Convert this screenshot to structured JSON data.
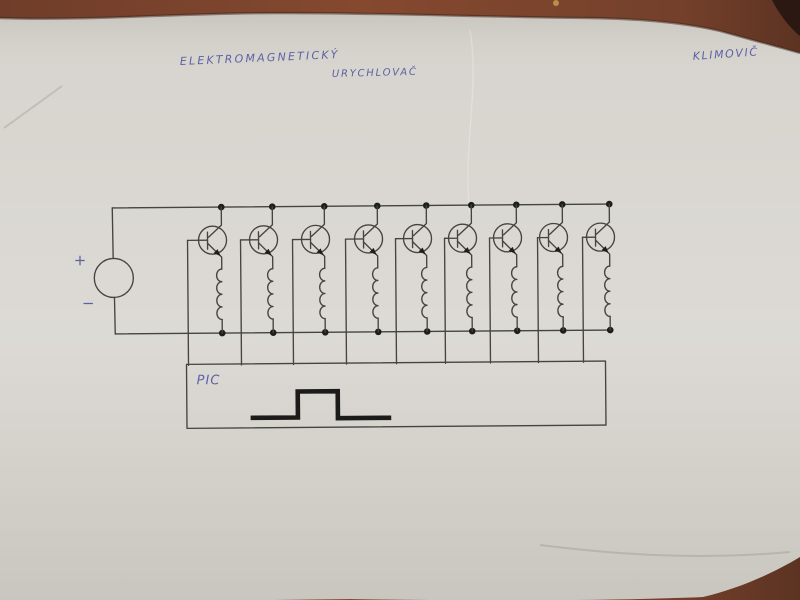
{
  "scene": {
    "description": "Photograph of a hand-drawn electronic schematic on a sheet of white paper lying on a reddish-brown wooden table",
    "table_color": "#7c4430",
    "table_dark_corner": "#2b1812",
    "paper_color": "#d6d3cd",
    "ink_color": "#45443f",
    "dot_color": "#1d1d1b",
    "pen_color": "#5c61a6",
    "pulse_color": "#1b1b19"
  },
  "handwriting": {
    "title_line1": "ELEKTROMAGNETICKÝ",
    "title_line2": "URYCHLOVAČ",
    "author": "KLIMOVIČ",
    "plus": "+",
    "minus": "−",
    "pic_label": "PIC"
  },
  "schematic": {
    "type": "circuit-diagram",
    "description": "Multi-stage electromagnetic accelerator (coilgun) driver: DC source on common supply rails feeding 9 NPN transistor stages, each transistor switching one accelerator coil; all transistor bases are driven by a PIC microcontroller box that outputs a rectangular pulse",
    "stage_count": 9,
    "rails": {
      "top_y": 206,
      "bottom_y": 332,
      "left_x": 113,
      "right_x": 610.5
    },
    "source": {
      "cx": 114,
      "cy": 276,
      "r": 19.5
    },
    "stages": [
      {
        "collector_x": 222,
        "base_x": 188
      },
      {
        "collector_x": 273,
        "base_x": 241
      },
      {
        "collector_x": 325,
        "base_x": 293
      },
      {
        "collector_x": 378,
        "base_x": 346
      },
      {
        "collector_x": 427,
        "base_x": 396
      },
      {
        "collector_x": 472,
        "base_x": 445
      },
      {
        "collector_x": 517,
        "base_x": 490
      },
      {
        "collector_x": 563,
        "base_x": 538
      },
      {
        "collector_x": 610,
        "base_x": 583
      }
    ],
    "transistor": {
      "circle_dx": -9,
      "circle_cy": 239,
      "r": 14
    },
    "coil": {
      "top_y": 268,
      "bumps": 4,
      "bump_h": 12.6,
      "bump_rx": 5.2
    },
    "pic_box": {
      "x": 186,
      "y": 363,
      "w": 419,
      "h": 64
    },
    "pulse_points": [
      [
        252,
        417
      ],
      [
        297,
        417
      ],
      [
        297,
        391
      ],
      [
        337,
        391
      ],
      [
        337,
        418
      ],
      [
        388,
        418
      ]
    ],
    "tilt_deg": -0.45
  }
}
